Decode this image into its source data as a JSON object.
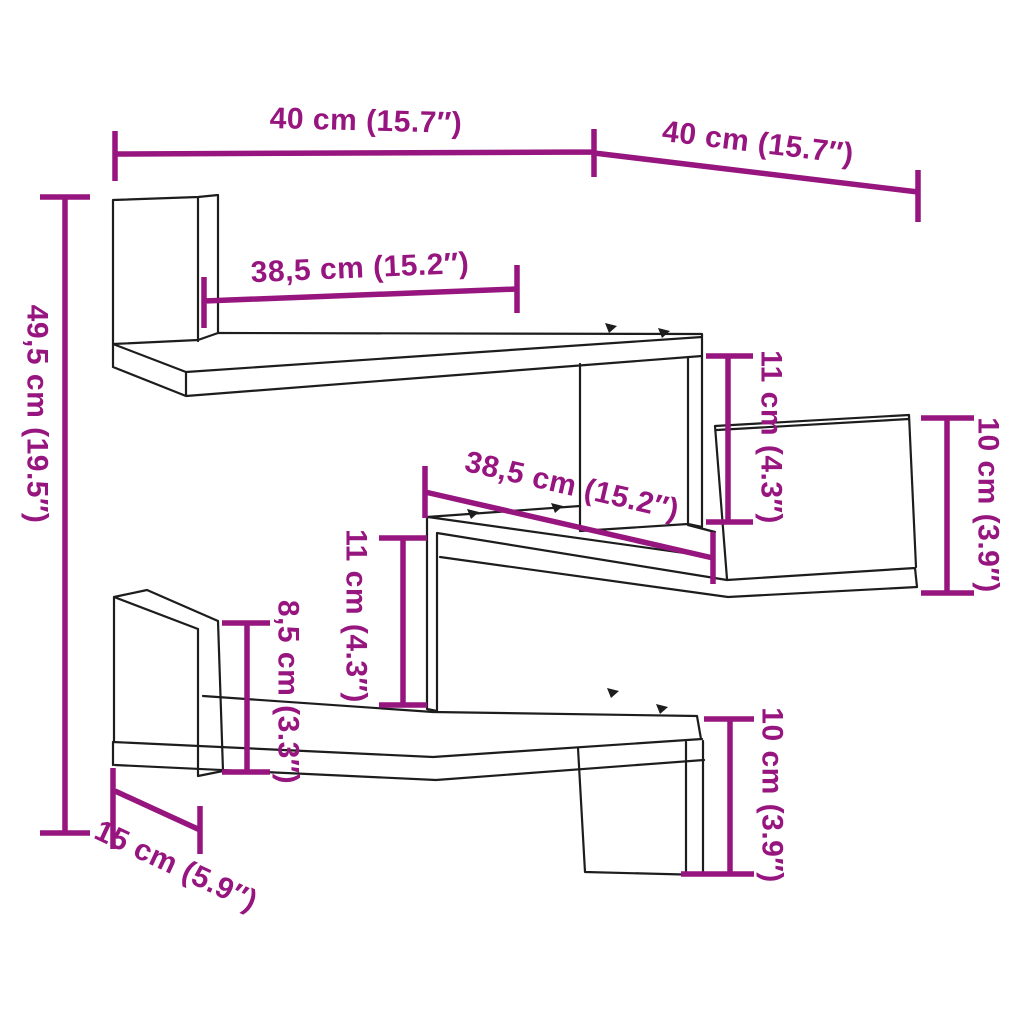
{
  "diagram": {
    "kind": "product-dimension-diagram",
    "subject": "three-tier zigzag corner wall shelf line drawing with dimension annotations"
  },
  "colors": {
    "dimension": "#97157E",
    "outline": "#1d1d1d",
    "background": "#ffffff"
  },
  "labels": {
    "width_top_left": "40 cm (15.7″)",
    "width_top_right": "40 cm (15.7″)",
    "height_total": "49,5 cm (19.5″)",
    "shelf_top_length": "38,5 cm (15.2″)",
    "shelf_middle_length": "38,5 cm (15.2″)",
    "clearance_right": "11 cm (4.3″)",
    "back_panel_right": "10 cm (3.9″)",
    "clearance_middle": "11 cm (4.3″)",
    "side_panel_left": "8,5 cm (3.3″)",
    "shelf_depth": "15 cm (5.9″)",
    "back_panel_bottom": "10 cm (3.9″)"
  }
}
